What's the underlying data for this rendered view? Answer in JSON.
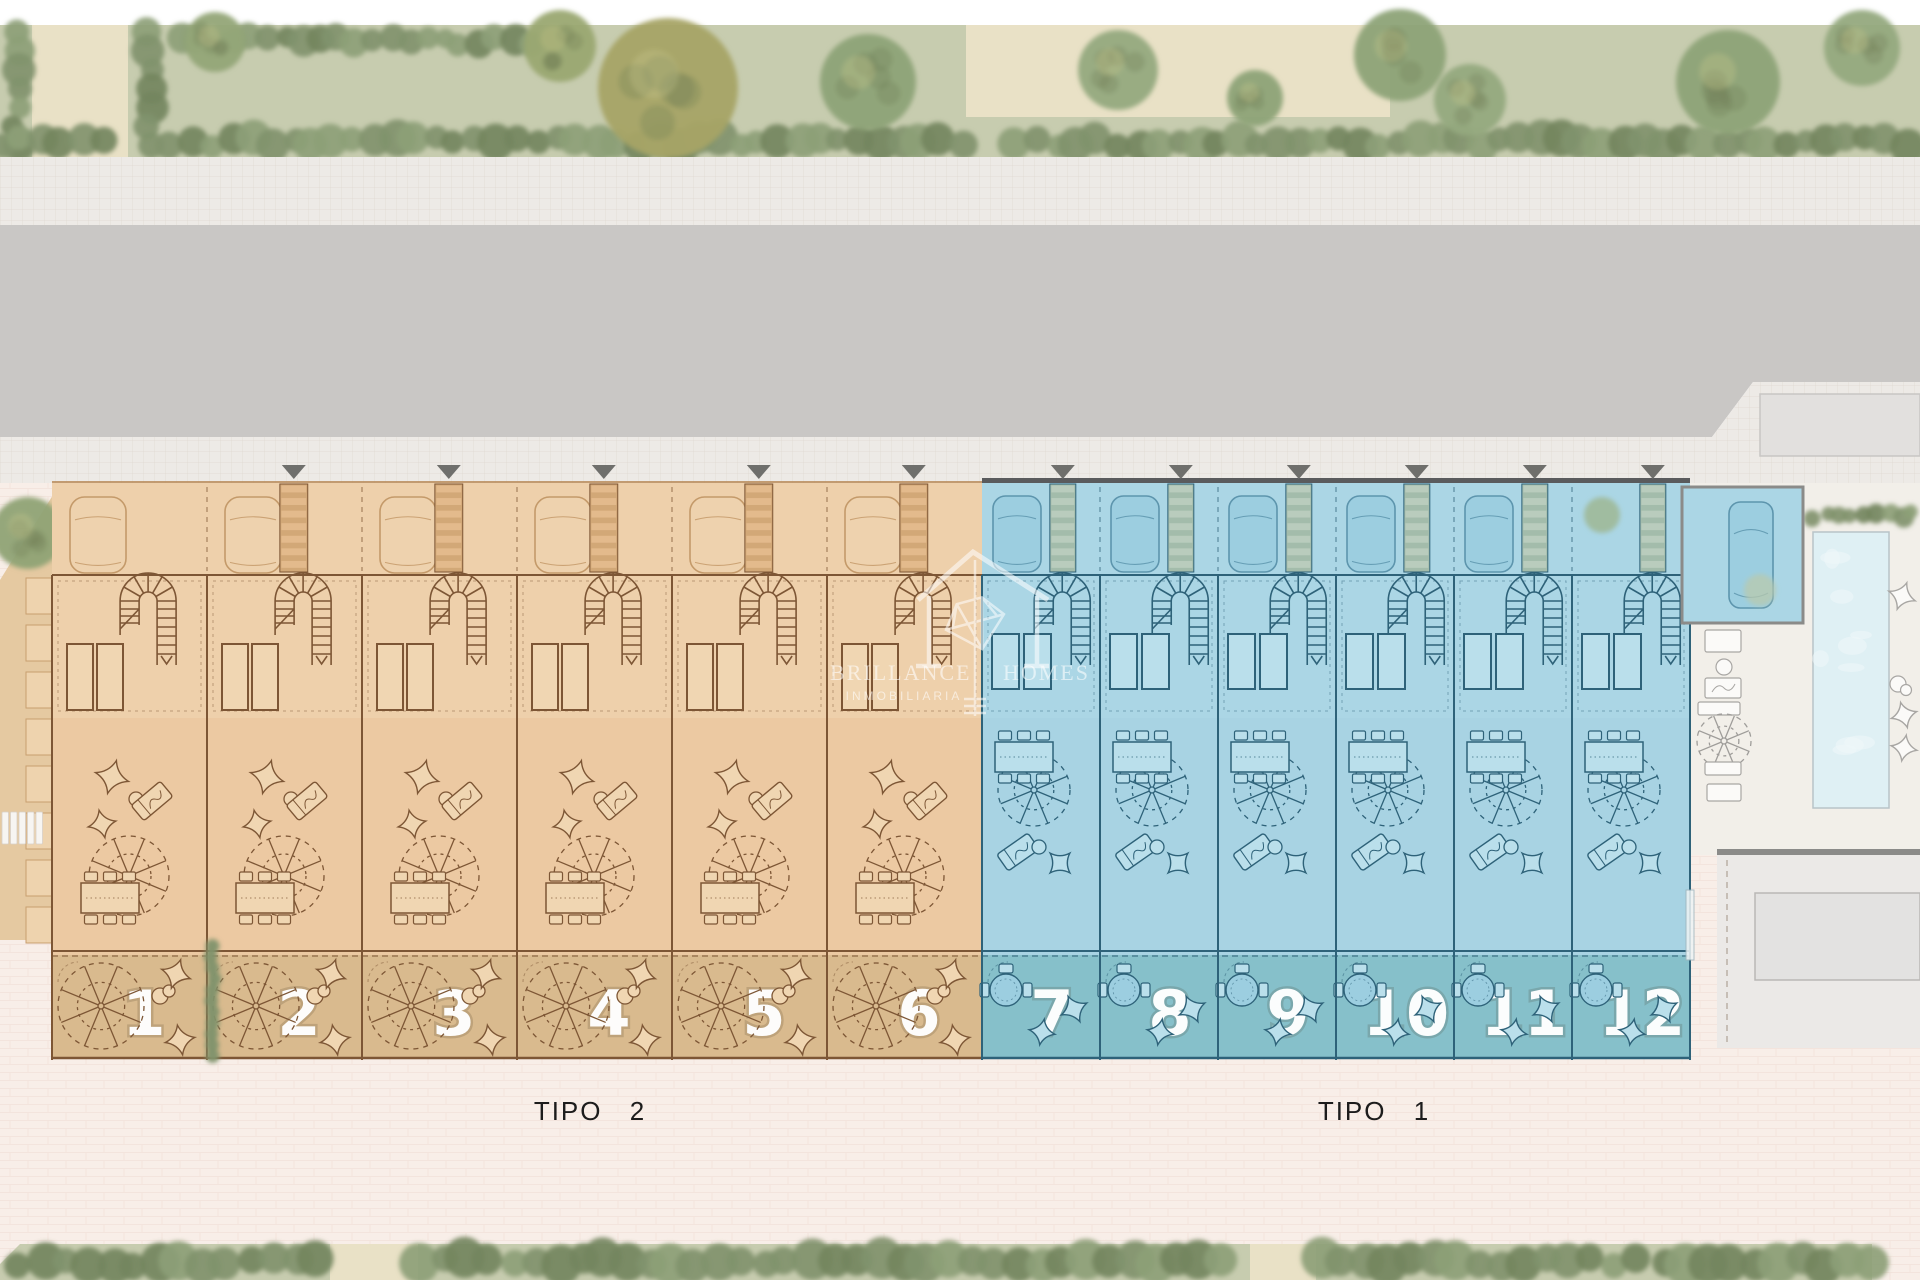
{
  "plan": {
    "labels": {
      "tipo2": "TIPO 2",
      "tipo1": "TIPO 1"
    },
    "watermark": {
      "brand": "BRILLANCE HOMES",
      "subtitle": "INMOBILIARIA"
    },
    "units": [
      {
        "number": "1",
        "type": "TIPO 2"
      },
      {
        "number": "2",
        "type": "TIPO 2"
      },
      {
        "number": "3",
        "type": "TIPO 2"
      },
      {
        "number": "4",
        "type": "TIPO 2"
      },
      {
        "number": "5",
        "type": "TIPO 2"
      },
      {
        "number": "6",
        "type": "TIPO 2"
      },
      {
        "number": "7",
        "type": "TIPO 1"
      },
      {
        "number": "8",
        "type": "TIPO 1"
      },
      {
        "number": "9",
        "type": "TIPO 1"
      },
      {
        "number": "10",
        "type": "TIPO 1"
      },
      {
        "number": "11",
        "type": "TIPO 1"
      },
      {
        "number": "12",
        "type": "TIPO 1"
      }
    ],
    "colors": {
      "tipo2_fill": "#ecc9a2",
      "tipo2_parking": "#eed0ab",
      "tipo2_garden": "#d9ba8e",
      "tipo2_outline": "#7d5635",
      "tipo1_fill": "#a8d3e3",
      "tipo1_parking": "#abd6e5",
      "tipo1_garden": "#86c0ca",
      "tipo1_outline": "#2e6279",
      "lawn": "#c7ccaf",
      "hedge": "#81936c",
      "sand": "#e9e1c6",
      "sidewalk": "#edeae6",
      "road": "#c9c7c5",
      "pavement": "#f8eee8",
      "pool_water": "#dff0f4",
      "pool_deck": "#f2efe9",
      "wall": "#8b8b89",
      "unit_number": "#ffffff",
      "label_text": "#1c1c1c",
      "watermark_text": "rgba(255,255,255,0.58)",
      "arrow": "#6f6f6c"
    }
  }
}
